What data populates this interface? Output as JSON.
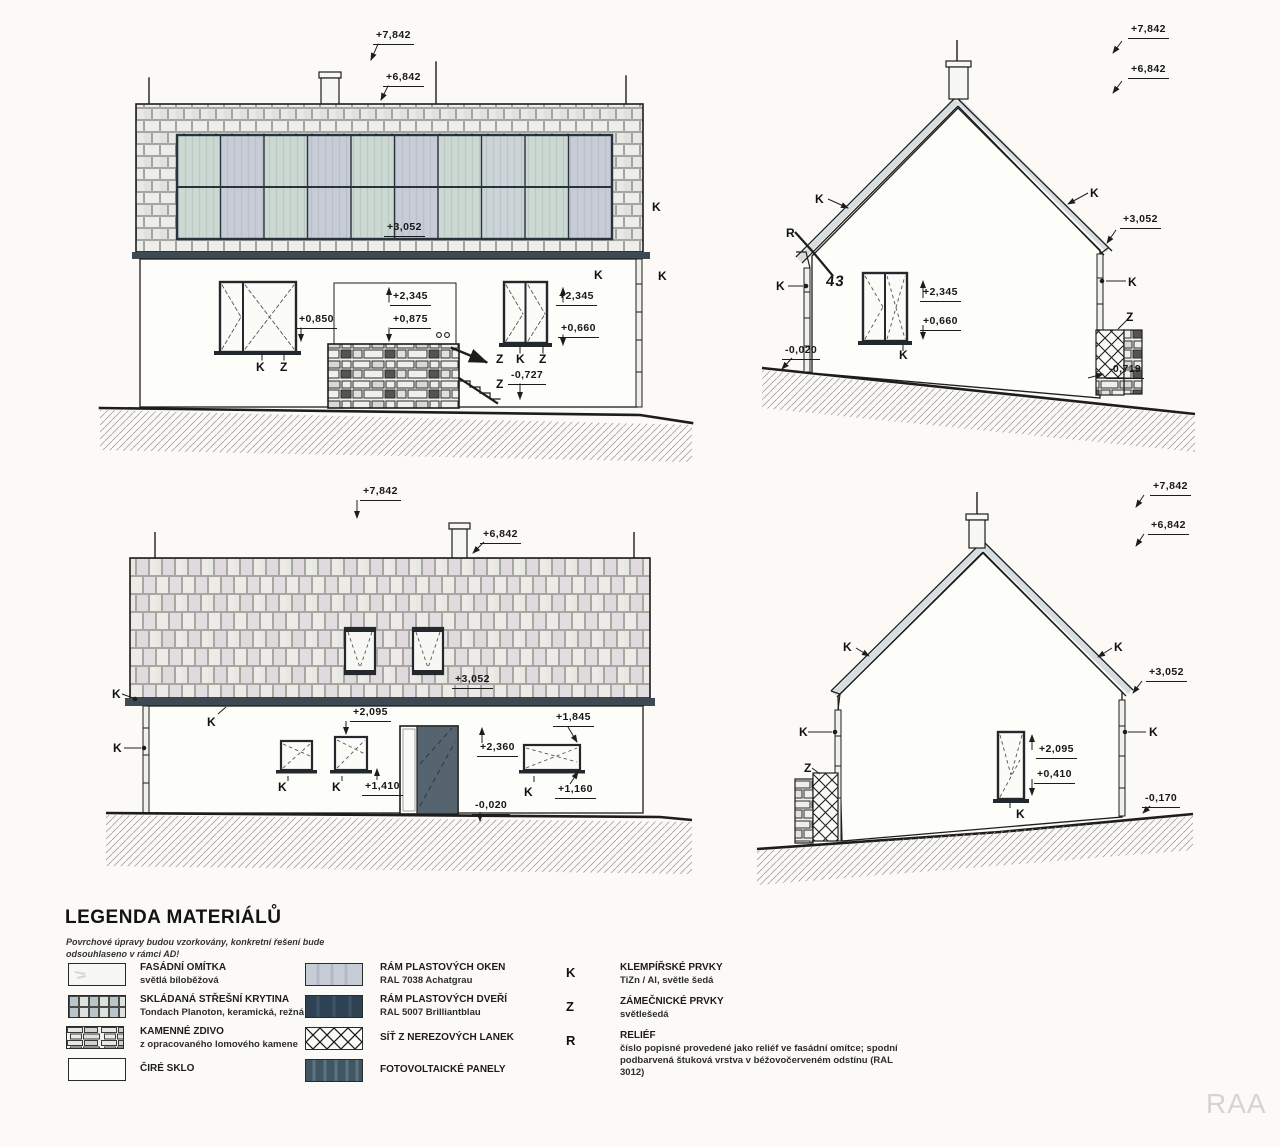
{
  "watermark": "RAA",
  "marks": {
    "k": "K",
    "z": "Z",
    "r": "R"
  },
  "elev_nw": {
    "ridge": "+7,842",
    "roof_top": "+6,842",
    "eave": "+3,052",
    "window_left_sill": "+0,850",
    "stone_height": "+2,345",
    "stone_top": "+0,875",
    "window_right_top": "+2,345",
    "window_right_sill": "+0,660",
    "terrace": "-0,727"
  },
  "elev_ne": {
    "ridge": "+7,842",
    "roof_top": "+6,842",
    "eave": "+3,052",
    "window_top": "+2,345",
    "window_sill": "+0,660",
    "ground_left": "-0,020",
    "plinth": "-0,719",
    "house_number": "43"
  },
  "elev_sw": {
    "ridge": "+7,842",
    "roof_top": "+6,842",
    "eave": "+3,052",
    "window_small_top": "+2,095",
    "window_small_sill": "+1,410",
    "door_top": "+2,360",
    "ground": "-0,020",
    "window_wide_top": "+1,845",
    "window_wide_sill": "+1,160"
  },
  "elev_se": {
    "ridge": "+7,842",
    "roof_top": "+6,842",
    "eave": "+3,052",
    "window_top": "+2,095",
    "window_sill": "+0,410",
    "ground_right": "-0,170"
  },
  "legend": {
    "title": "LEGENDA MATERIÁLŮ",
    "note1": "Povrchové úpravy budou vzorkovány, konkretní řešení bude",
    "note2": "odsouhlaseno v rámci AD!",
    "materials": [
      {
        "name": "FASÁDNÍ OMÍTKA",
        "desc": "světlá bíloběžová"
      },
      {
        "name": "SKLÁDANÁ STŘEŠNÍ KRYTINA",
        "desc": "Tondach Planoton, keramická, režná"
      },
      {
        "name": "KAMENNÉ ZDIVO",
        "desc": "z opracovaného lomového kamene"
      },
      {
        "name": "ČIRÉ SKLO",
        "desc": ""
      },
      {
        "name": "RÁM PLASTOVÝCH OKEN",
        "desc": "RAL 7038 Achatgrau"
      },
      {
        "name": "RÁM PLASTOVÝCH DVEŘÍ",
        "desc": "RAL 5007 Brilliantblau"
      },
      {
        "name": "SÍŤ Z NEREZOVÝCH LANEK",
        "desc": ""
      },
      {
        "name": "FOTOVOLTAICKÉ PANELY",
        "desc": ""
      }
    ],
    "letters": [
      {
        "key": "K",
        "name": "KLEMPÍŘSKÉ PRVKY",
        "desc": "TiZn / Al, světle šedá"
      },
      {
        "key": "Z",
        "name": "ZÁMEČNICKÉ PRVKY",
        "desc": "světlešedá"
      },
      {
        "key": "R",
        "name": "RELIÉF",
        "desc": "číslo popisné provedené jako reliéf ve fasádní omítce; spodní podbarvená štuková vrstva v béžovočerveném odstínu (RAL 3012)"
      }
    ]
  },
  "colors": {
    "gutter": "#3e4a52",
    "pv_panel_a": "#ccd8d2",
    "pv_panel_b": "#c8cbd8",
    "door": "#566470",
    "ral7038": "#c7cdd6",
    "ral5007": "#2f4254",
    "roof_band": "#d5dde0"
  }
}
